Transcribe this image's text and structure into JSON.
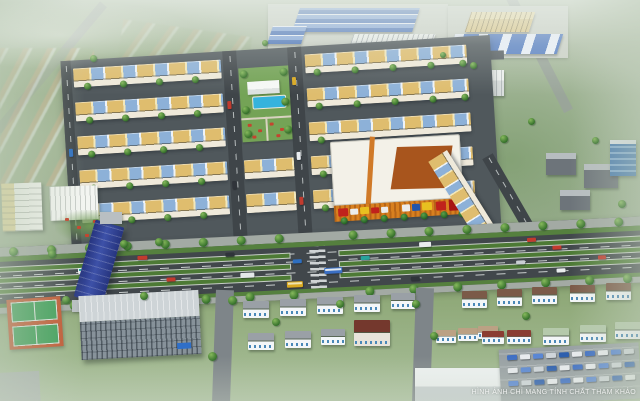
{
  "scene": {
    "kind": "aerial-3d-masterplan-render",
    "watermark": "HÌNH ẢNH CHỈ MANG TÍNH CHẤT THAM KHẢO"
  },
  "palette": {
    "haze_green": "#a9bba0",
    "asphalt": "#41474b",
    "median_green": "#4d7a35",
    "shophouse_roof_tan": "#dfbd6e",
    "shophouse_roof_blue": "#8db1d8",
    "mall_roof_white": "#f3f1e8",
    "mall_roof_orange": "#a8551d",
    "mall_facade_orange": "#d8801f",
    "pool_blue": "#35b3dd",
    "factory_roof_blue": "#4f77bb",
    "tennis_court_orange": "#c2542e",
    "tennis_court_green": "#3c9e57",
    "overpass_blue": "#2e3e8c",
    "lawn_green": "#8ba573",
    "villa_roof_gray": "#9aa0a6",
    "villa_roof_brown": "#7b5a48"
  }
}
